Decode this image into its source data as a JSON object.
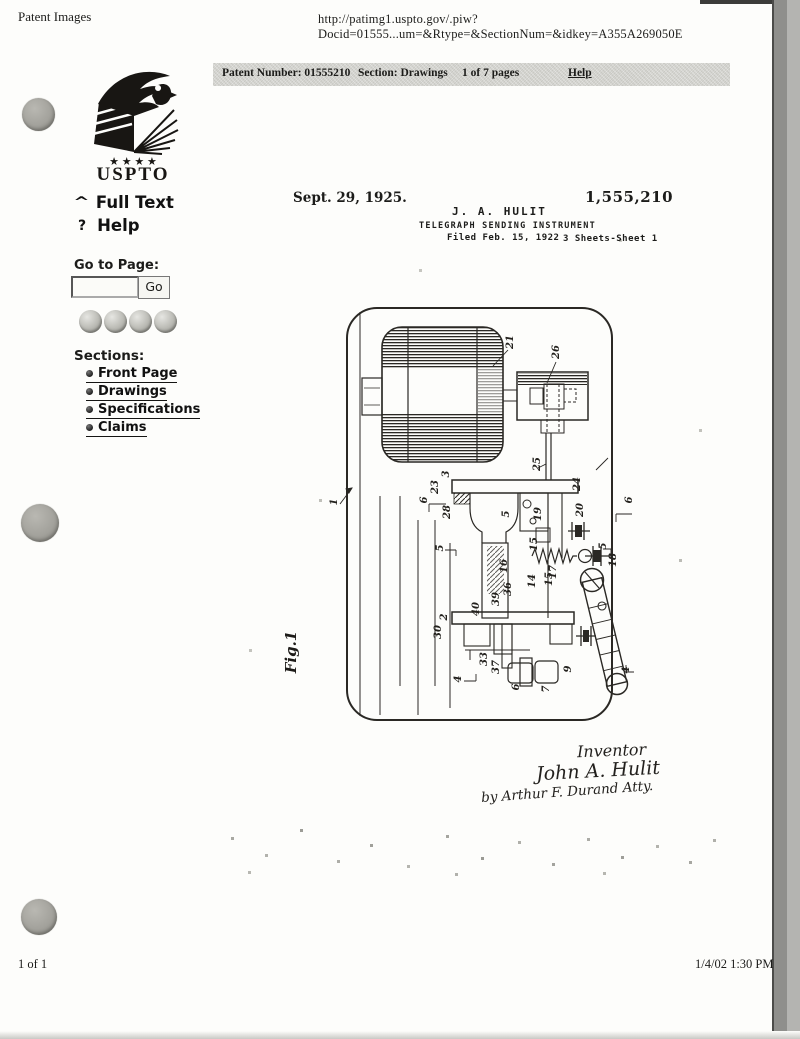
{
  "browser": {
    "title": "Patent Images",
    "url": "http://patimg1.uspto.gov/.piw?Docid=01555...um=&Rtype=&SectionNum=&idkey=A355A269050E"
  },
  "info_bar": {
    "patent_number": "Patent Number: 01555210",
    "section": "Section: Drawings",
    "pages": "1 of 7 pages",
    "help": "Help"
  },
  "sidebar": {
    "logo_text": "USPTO",
    "logo_stars": "★ ★ ★ ★",
    "full_text_label": "Full Text",
    "help_label": "Help",
    "help_icon_glyph": "?",
    "goto_label": "Go to Page:",
    "goto_value": "",
    "go_button": "Go",
    "sections_label": "Sections:",
    "sections": [
      {
        "label": "Front Page"
      },
      {
        "label": "Drawings"
      },
      {
        "label": "Specifications"
      },
      {
        "label": "Claims"
      }
    ],
    "nav_buttons": [
      {
        "icon": "sphere-button"
      },
      {
        "icon": "sphere-button"
      },
      {
        "icon": "sphere-button"
      },
      {
        "icon": "sphere-button"
      }
    ]
  },
  "patent_sheet": {
    "date": "Sept. 29, 1925.",
    "patent_number": "1,555,210",
    "inventor_header": "J. A. HULIT",
    "title": "TELEGRAPH SENDING INSTRUMENT",
    "filed": "Filed Feb. 15, 1922",
    "sheets": "3 Sheets-Sheet 1",
    "figure_label": "Fig.1",
    "figure_labels": [
      {
        "n": "21",
        "x": 233,
        "y": 54
      },
      {
        "n": "26",
        "x": 279,
        "y": 64
      },
      {
        "n": "25",
        "x": 260,
        "y": 176
      },
      {
        "n": "1",
        "x": 57,
        "y": 214
      },
      {
        "n": "3",
        "x": 169,
        "y": 186
      },
      {
        "n": "23",
        "x": 158,
        "y": 199
      },
      {
        "n": "6",
        "x": 147,
        "y": 212
      },
      {
        "n": "28",
        "x": 170,
        "y": 224
      },
      {
        "n": "5",
        "x": 163,
        "y": 260
      },
      {
        "n": "24",
        "x": 300,
        "y": 196
      },
      {
        "n": "19",
        "x": 261,
        "y": 226
      },
      {
        "n": "5",
        "x": 229,
        "y": 226
      },
      {
        "n": "20",
        "x": 303,
        "y": 222
      },
      {
        "n": "15",
        "x": 257,
        "y": 256
      },
      {
        "n": "16",
        "x": 227,
        "y": 278
      },
      {
        "n": "17",
        "x": 276,
        "y": 284
      },
      {
        "n": "18",
        "x": 336,
        "y": 272
      },
      {
        "n": "5",
        "x": 326,
        "y": 258
      },
      {
        "n": "6",
        "x": 352,
        "y": 212
      },
      {
        "n": "14",
        "x": 255,
        "y": 293
      },
      {
        "n": "15",
        "x": 272,
        "y": 291
      },
      {
        "n": "36",
        "x": 231,
        "y": 301
      },
      {
        "n": "39",
        "x": 219,
        "y": 311
      },
      {
        "n": "40",
        "x": 199,
        "y": 321
      },
      {
        "n": "2",
        "x": 167,
        "y": 329
      },
      {
        "n": "30",
        "x": 161,
        "y": 344
      },
      {
        "n": "33",
        "x": 207,
        "y": 371
      },
      {
        "n": "37",
        "x": 219,
        "y": 379
      },
      {
        "n": "9",
        "x": 291,
        "y": 381
      },
      {
        "n": "6",
        "x": 239,
        "y": 399
      },
      {
        "n": "7",
        "x": 269,
        "y": 401
      },
      {
        "n": "4",
        "x": 349,
        "y": 382
      },
      {
        "n": "4",
        "x": 181,
        "y": 391
      }
    ],
    "signature": {
      "line1": "Inventor",
      "line2": "John A. Hulit",
      "line3": "by Arthur F. Durand    Atty."
    }
  },
  "footer": {
    "left": "1 of 1",
    "right": "1/4/02 1:30 PM"
  }
}
